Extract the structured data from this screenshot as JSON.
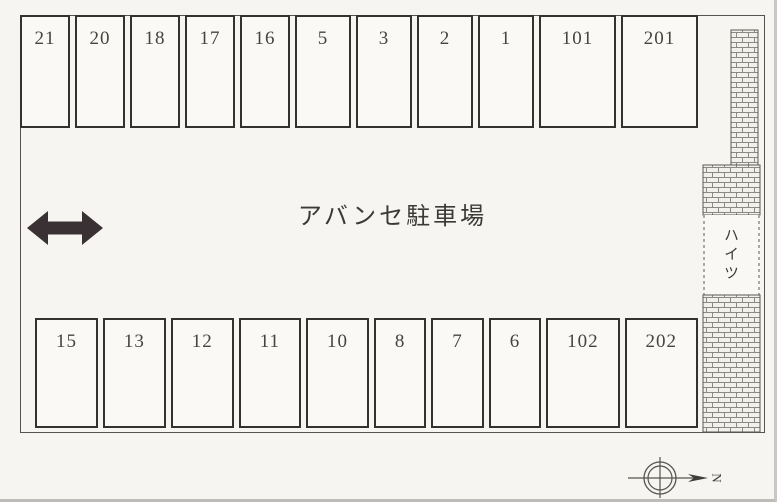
{
  "lot": {
    "title": "アバンセ駐車場",
    "top_row": [
      "21",
      "20",
      "18",
      "17",
      "16",
      "5",
      "3",
      "2",
      "1",
      "101",
      "201"
    ],
    "bottom_row": [
      "15",
      "13",
      "12",
      "11",
      "10",
      "8",
      "7",
      "6",
      "102",
      "202"
    ],
    "building_label": "ハイツ",
    "compass_label": "N"
  },
  "colors": {
    "paper": "#f6f5f2",
    "line": "#56544f",
    "arrow": "#3a3134",
    "brick-mortar": "#8a8982"
  }
}
